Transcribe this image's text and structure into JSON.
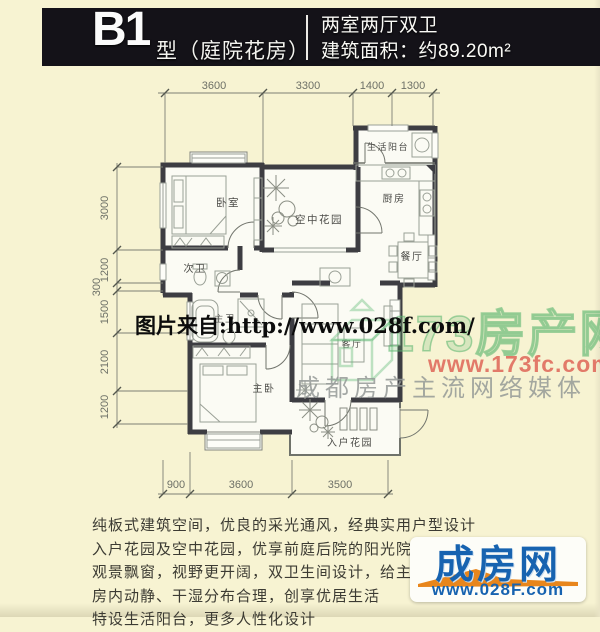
{
  "header": {
    "unit_code": "B1",
    "unit_suffix": "型（庭院花房）",
    "layout": "两室两厅双卫",
    "area": "建筑面积：约89.20m²"
  },
  "floorplan": {
    "rooms": {
      "bedroom": "卧室",
      "sky_garden": "空中花园",
      "life_balcony": "生活阳台",
      "kitchen": "厨房",
      "dining": "餐厅",
      "second_bath": "次卫",
      "master_bath": "主卫",
      "master_bedroom": "主卧",
      "living": "客厅",
      "entry_garden": "入户花园"
    },
    "dims": {
      "top": [
        "3600",
        "3300",
        "1400",
        "1300"
      ],
      "left": [
        "3000",
        "1200",
        "300",
        "1500",
        "2100",
        "1200"
      ],
      "bottom": [
        "900",
        "3600",
        "3500"
      ]
    }
  },
  "watermarks": {
    "image_source": "图片来自:http://www.028f.com/",
    "site_name": "173房产网",
    "site_url": "www.173fc.com",
    "site_slogan": "成都房产主流网络媒体"
  },
  "description": {
    "lines": [
      "纯板式建筑空间，优良的采光通风，经典实用户型设计",
      "入户花园及空中花园，优享前庭后院的阳光院落生活",
      "观景飘窗，视野更开阔，双卫生间设计，给主人更",
      "房内动静、干湿分布合理，创享优居生活",
      "特设生活阳台，更多人性化设计"
    ]
  },
  "brand": {
    "name": "成房网",
    "url": "www.028F.com"
  },
  "colors": {
    "page_bg": "#f7f3d2",
    "header_bg": "#141218",
    "wall": "#3d3d42",
    "brand_blue": "#1763b0",
    "brand_orange": "#e8861c",
    "watermark_green": "#64b973",
    "watermark_red": "#dd574b"
  }
}
